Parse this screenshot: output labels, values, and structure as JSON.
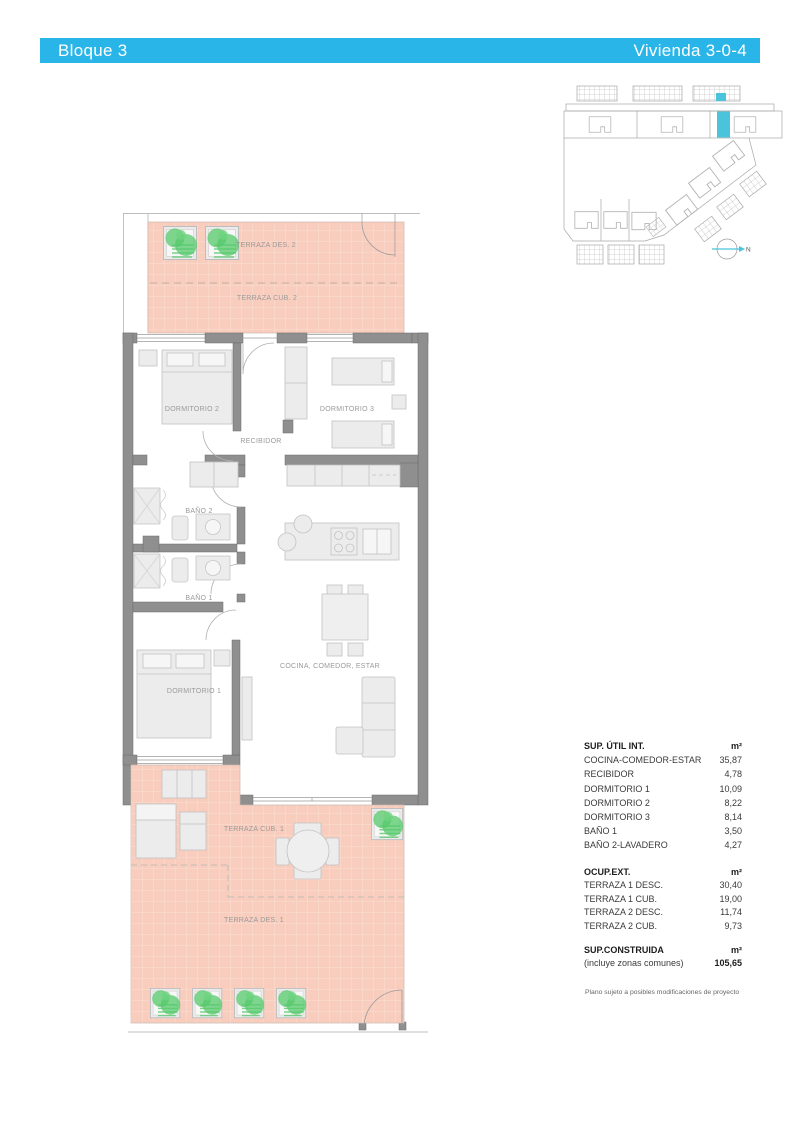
{
  "header": {
    "block": "Bloque 3",
    "unit": "Vivienda 3-0-4"
  },
  "site_plan": {
    "north_label": "N",
    "highlight_color": "#4ac3db"
  },
  "floorplan": {
    "labels": {
      "terraza_des_2": "TERRAZA DES. 2",
      "terraza_cub_2": "TERRAZA CUB. 2",
      "dormitorio_2": "DORMITORIO 2",
      "dormitorio_3": "DORMITORIO 3",
      "recibidor": "RECIBIDOR",
      "bano_2": "BAÑO 2",
      "bano_1": "BAÑO 1",
      "dormitorio_1": "DORMITORIO 1",
      "cocina_comedor_estar": "COCINA, COMEDOR, ESTAR",
      "terraza_cub_1": "TERRAZA CUB. 1",
      "terraza_des_1": "TERRAZA DES. 1"
    }
  },
  "tables": {
    "util": {
      "title": "SUP. ÚTIL INT.",
      "unit": "m²",
      "rows": [
        {
          "label": "COCINA-COMEDOR-ESTAR",
          "value": "35,87"
        },
        {
          "label": "RECIBIDOR",
          "value": "4,78"
        },
        {
          "label": "DORMITORIO 1",
          "value": "10,09"
        },
        {
          "label": "DORMITORIO 2",
          "value": "8,22"
        },
        {
          "label": "DORMITORIO 3",
          "value": "8,14"
        },
        {
          "label": "BAÑO 1",
          "value": "3,50"
        },
        {
          "label": "BAÑO 2-LAVADERO",
          "value": "4,27"
        }
      ]
    },
    "ext": {
      "title": "OCUP.EXT.",
      "unit": "m²",
      "rows": [
        {
          "label": "TERRAZA 1 DESC.",
          "value": "30,40"
        },
        {
          "label": "TERRAZA 1 CUB.",
          "value": "19,00"
        },
        {
          "label": "TERRAZA 2 DESC.",
          "value": "11,74"
        },
        {
          "label": "TERRAZA 2 CUB.",
          "value": "9,73"
        }
      ]
    },
    "built": {
      "title": "SUP.CONSTRUIDA",
      "subtitle": "(incluye zonas comunes)",
      "unit": "m²",
      "value": "105,65"
    }
  },
  "footnote": "Plano sujeto a posibles modificaciones de proyecto"
}
